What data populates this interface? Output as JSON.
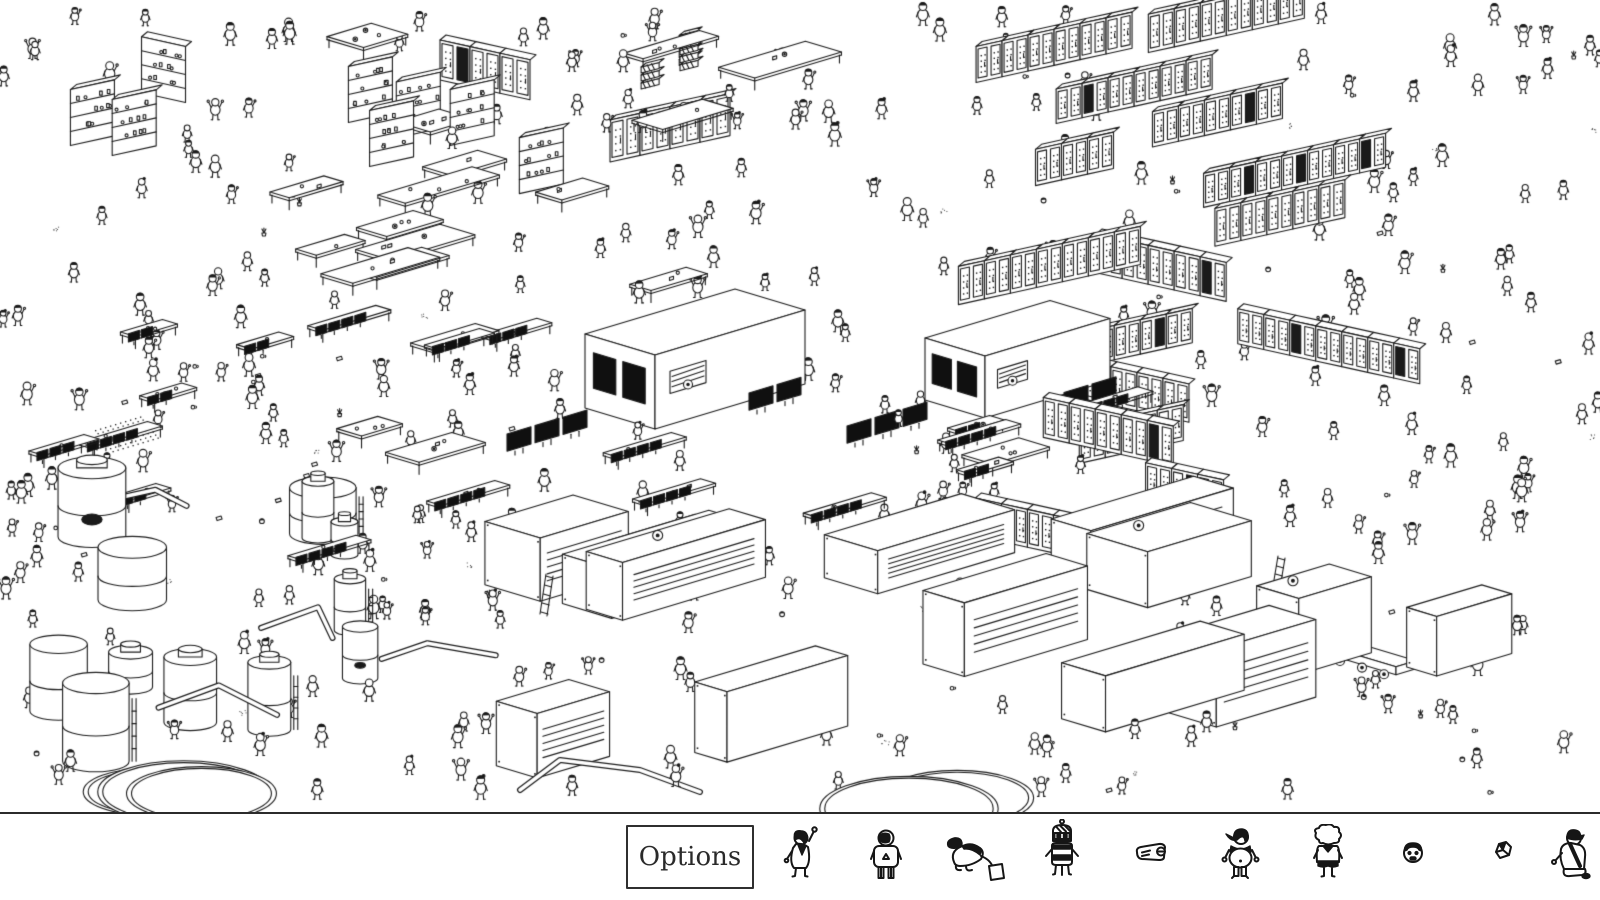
{
  "colors": {
    "background": "#ffffff",
    "ink": "#1a1a1a",
    "separator": "#2b2b2b",
    "screen_fill": "#101010"
  },
  "bottom_bar": {
    "options_label": "Options",
    "targets": [
      {
        "name": "waving-person"
      },
      {
        "name": "hooded-person"
      },
      {
        "name": "crouching-person-with-bag"
      },
      {
        "name": "robot-with-antenna"
      },
      {
        "name": "flat-gadget"
      },
      {
        "name": "dark-haired-person"
      },
      {
        "name": "fluffy-haired-person"
      },
      {
        "name": "small-head"
      },
      {
        "name": "crumpled-paper"
      },
      {
        "name": "kneeling-person-with-cap"
      }
    ]
  },
  "scene": {
    "seed": 11,
    "width": 1600,
    "height": 812,
    "regions": {
      "top": {
        "x": 0,
        "y": 10,
        "w": 940,
        "h": 300,
        "tables": 15,
        "shelves": 8,
        "crates": 3
      },
      "racks": {
        "x": 930,
        "y": 5,
        "w": 670,
        "h": 545,
        "rows": 16
      },
      "mid": {
        "x": 20,
        "y": 310,
        "w": 1140,
        "h": 250,
        "monitor_desks": 19,
        "tables": 7
      },
      "tanks": {
        "x": 10,
        "y": 470,
        "w": 460,
        "h": 330,
        "count": 12,
        "pipes": 4,
        "vats": 3
      },
      "bottom": {
        "x": 480,
        "y": 545,
        "w": 1120,
        "h": 260,
        "containers": 14,
        "trucks": 2,
        "ladders": 2,
        "vats": 2
      },
      "machines": [
        {
          "x": 585,
          "y": 408,
          "a": 150,
          "b": 70,
          "h": 74
        },
        {
          "x": 925,
          "y": 400,
          "a": 125,
          "b": 60,
          "h": 62
        }
      ],
      "mats": [
        {
          "x": 95,
          "y": 430
        }
      ],
      "people": 330,
      "clutter": 80
    }
  }
}
